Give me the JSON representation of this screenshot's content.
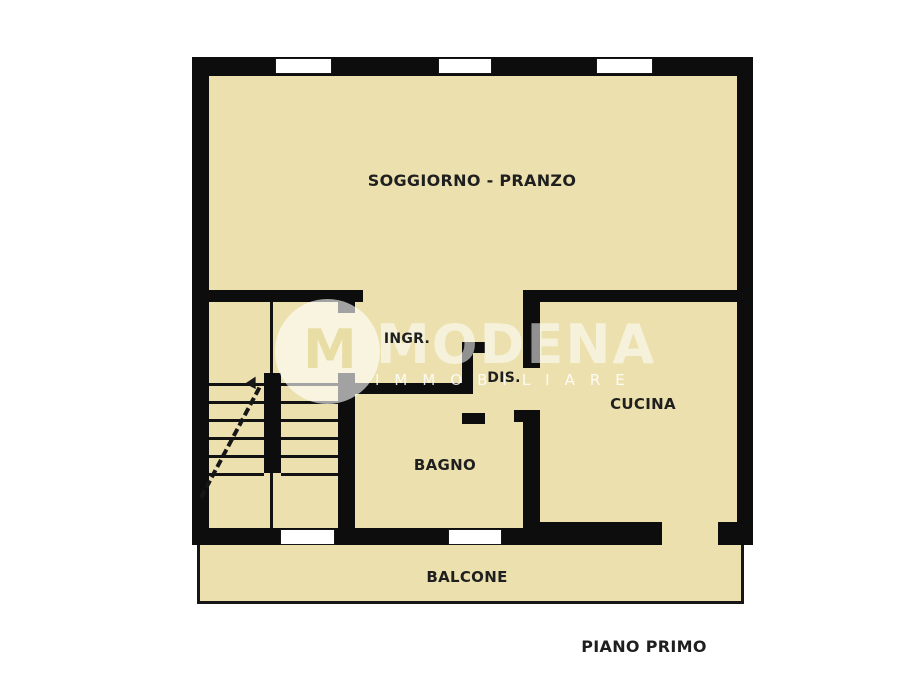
{
  "plan": {
    "colors": {
      "floor_fill": "#ece1ae",
      "wall": "#0d0d0d",
      "label_text": "#1f1f1f",
      "window_fill": "#ffffff"
    },
    "rooms": {
      "soggiorno": {
        "label": "SOGGIORNO - PRANZO"
      },
      "ingresso": {
        "label": "INGR."
      },
      "disimpegno": {
        "label": "DIS."
      },
      "cucina": {
        "label": "CUCINA"
      },
      "bagno": {
        "label": "BAGNO"
      },
      "balcone": {
        "label": "BALCONE"
      }
    },
    "floor_title": "PIANO PRIMO"
  },
  "watermark": {
    "brand": "MODENA",
    "subtitle": "IMMOBILIARE",
    "logo_letter": "M"
  }
}
